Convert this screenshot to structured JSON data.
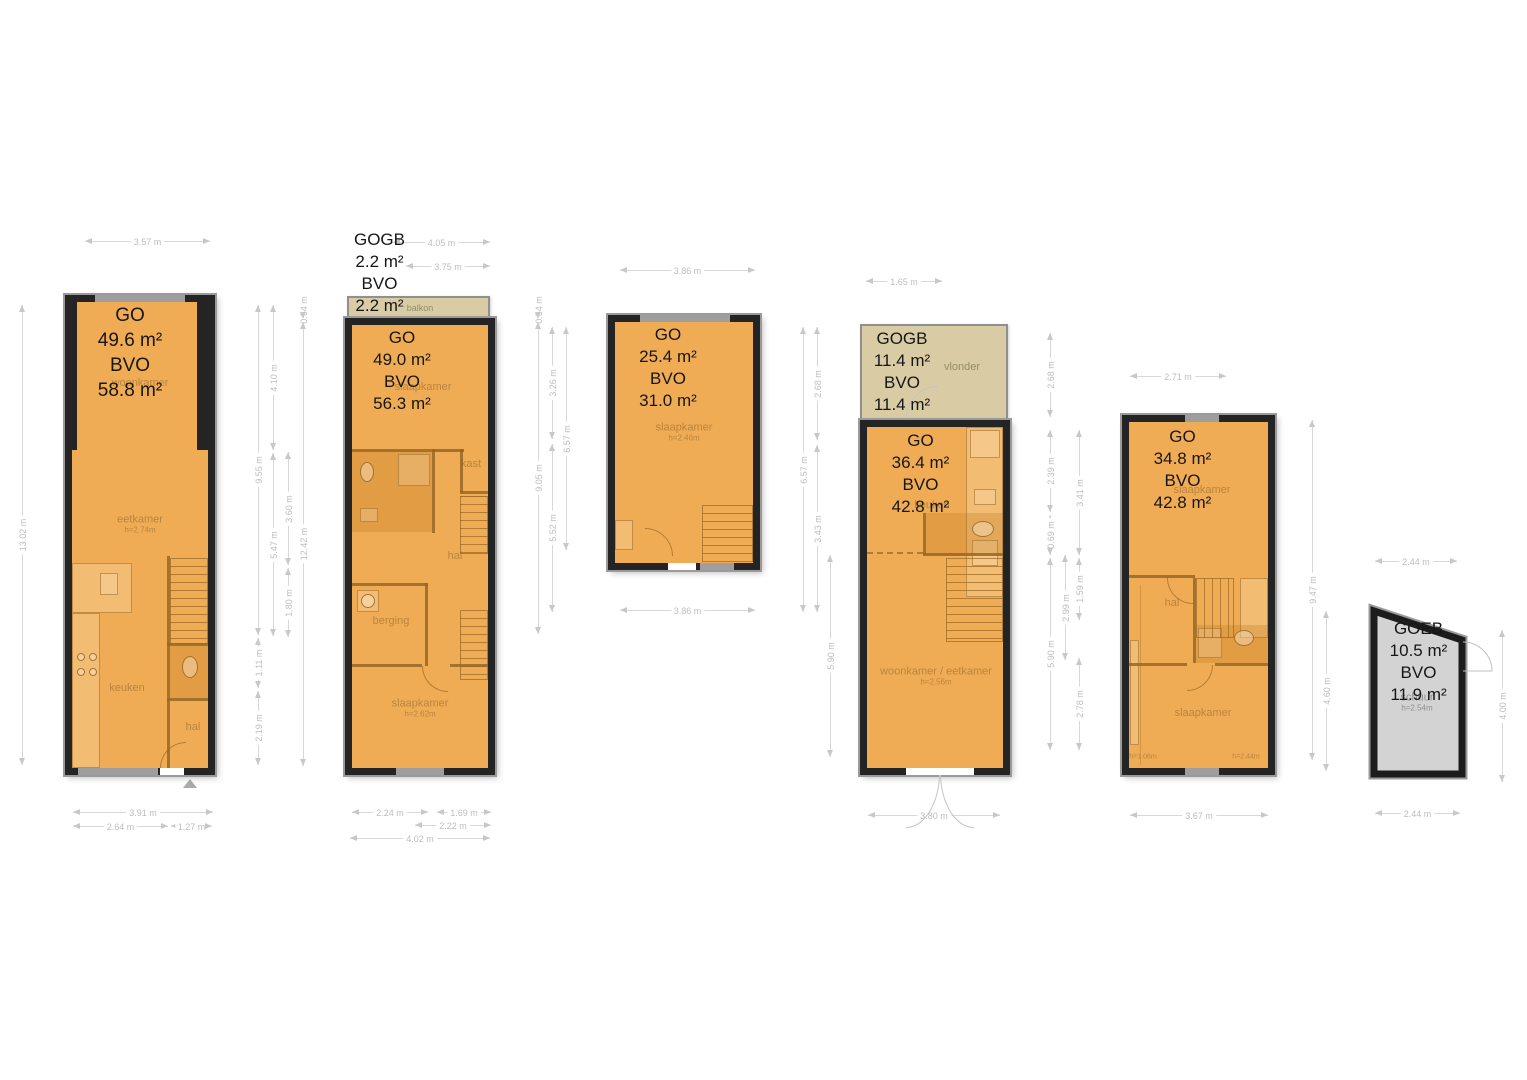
{
  "colors": {
    "floor_fill": "#F0AC55",
    "wall": "#242424",
    "balcony_fill": "#D9CCA4",
    "shed_fill": "#D3D3D3",
    "dimension_grey": "#BDBDBD",
    "room_label_brown": "#8C6428"
  },
  "plans": [
    {
      "label": [
        "GO",
        "49.6 m²",
        "BVO",
        "58.8 m²"
      ],
      "rooms": [
        {
          "n": "woonkamer"
        },
        {
          "n": "eetkamer",
          "h": "h=2.74m"
        },
        {
          "n": "keuken"
        },
        {
          "n": "hal"
        }
      ],
      "dims": {
        "top": [
          "3.57 m"
        ],
        "left": [
          "13.02 m"
        ],
        "right": [
          "9.55 m",
          "1.11 m",
          "2.19 m",
          "4.10 m",
          "5.47 m",
          "3.60 m",
          "1.80 m",
          "0.54 m",
          "12.42 m"
        ],
        "bottom": [
          "3.91 m",
          "2.64 m",
          "1.27 m"
        ]
      }
    },
    {
      "balcony": {
        "label": [
          "GOGB",
          "2.2 m²",
          "BVO",
          "2.2 m²"
        ],
        "room": "balkon"
      },
      "label": [
        "GO",
        "49.0 m²",
        "BVO",
        "56.3 m²"
      ],
      "rooms": [
        {
          "n": "slaapkamer"
        },
        {
          "n": "kast"
        },
        {
          "n": "hal"
        },
        {
          "n": "berging"
        },
        {
          "n": "slaapkamer",
          "h": "h=2.62m"
        }
      ],
      "dims": {
        "top": [
          "4.05 m",
          "3.75 m"
        ],
        "right": [
          "0.54 m",
          "9.05 m",
          "3.26 m",
          "5.52 m",
          "6.57 m"
        ],
        "bottom": [
          "2.24 m",
          "1.69 m",
          "2.22 m",
          "4.02 m"
        ]
      }
    },
    {
      "label": [
        "GO",
        "25.4 m²",
        "BVO",
        "31.0 m²"
      ],
      "rooms": [
        {
          "n": "slaapkamer",
          "h": "h=2.46m"
        }
      ],
      "dims": {
        "top": [
          "3.86 m"
        ],
        "right": [
          "6.57 m",
          "2.68 m",
          "3.43 m"
        ],
        "bottom": [
          "3.86 m"
        ]
      }
    },
    {
      "deck": {
        "label": [
          "GOGB",
          "11.4 m²",
          "BVO",
          "11.4 m²"
        ],
        "room": "vlonder"
      },
      "label": [
        "GO",
        "36.4 m²",
        "BVO",
        "42.8 m²"
      ],
      "rooms": [
        {
          "n": "keuken"
        },
        {
          "n": "woonkamer / eetkamer",
          "h": "h=2.56m"
        }
      ],
      "dims": {
        "top": [
          "1.65 m"
        ],
        "left": [
          "5.90 m"
        ],
        "right": [
          "2.68 m",
          "2.39 m",
          "0.69 m",
          "5.90 m",
          "2.99 m",
          "3.41 m",
          "1.59 m",
          "2.78 m"
        ],
        "bottom": [
          "3.80 m"
        ]
      }
    },
    {
      "label": [
        "GO",
        "34.8 m²",
        "BVO",
        "42.8 m²"
      ],
      "rooms": [
        {
          "n": "slaapkamer"
        },
        {
          "n": "hal"
        },
        {
          "n": "slaapkamer"
        }
      ],
      "heights": {
        "h1": "h=1.06m",
        "h2": "h=2.44m"
      },
      "dims": {
        "top": [
          "2.71 m"
        ],
        "right": [
          "9.47 m",
          "4.60 m"
        ],
        "bottom": [
          "3.67 m"
        ]
      }
    },
    {
      "label": [
        "GOEB",
        "10.5 m²",
        "BVO",
        "11.9 m²"
      ],
      "rooms": [
        {
          "n": "schuur",
          "h": "h=2.54m"
        }
      ],
      "dims": {
        "top": [
          "2.44 m"
        ],
        "right": [
          "4.00 m"
        ],
        "bottom": [
          "2.44 m"
        ]
      }
    }
  ]
}
